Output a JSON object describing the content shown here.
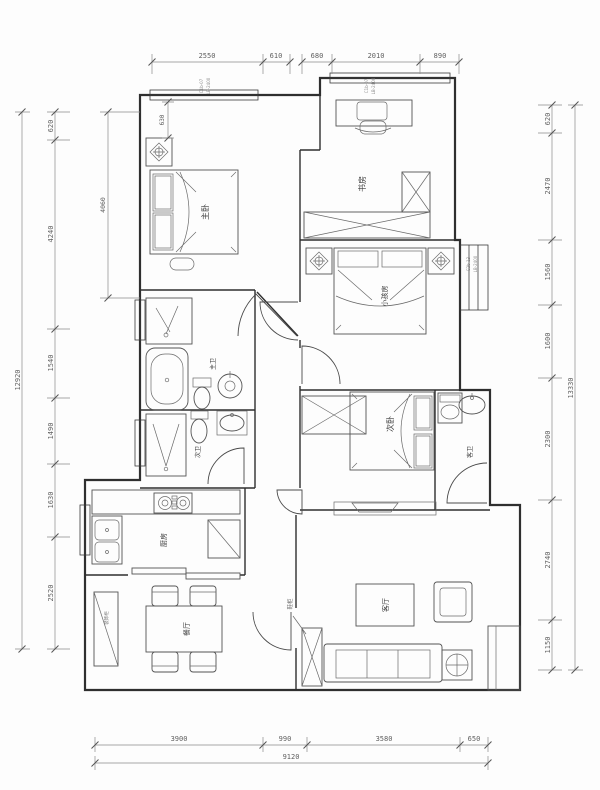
{
  "drawing": {
    "kind": "apartment-floor-plan",
    "line_color": "#2f2f2f",
    "background": "#fdfdfd",
    "rooms": {
      "master_bedroom": "主卧",
      "study": "书房",
      "kids_room": "小孩房",
      "second_bedroom": "次卧",
      "master_bath": "主卫",
      "second_bath": "次卫",
      "guest_bath": "客卫",
      "kitchen": "厨房",
      "dining": "餐厅",
      "living": "客厅"
    },
    "annotations": {
      "shoe_cabinet": "鞋柜",
      "hall_cabinet": "装饰柜"
    },
    "window_codes": {
      "top_left": [
        "C1b-07",
        "LB-2400"
      ],
      "top_right": [
        "C1b-07",
        "LB-2400"
      ],
      "right_side": [
        "C2b-13",
        "LB-2400"
      ]
    },
    "dims": {
      "top": [
        "2550",
        "610",
        "680",
        "2010",
        "890"
      ],
      "bottom": [
        "3900",
        "990",
        "3580",
        "650"
      ],
      "bottom_total": "9120",
      "left": [
        "620",
        "4240",
        "1540",
        "1490",
        "1630",
        "2520"
      ],
      "left_total": "12920",
      "right": [
        "620",
        "2470",
        "1560",
        "1600",
        "2300",
        "2740",
        "1150"
      ],
      "right_total": "13330",
      "internal": {
        "window_offset": "630",
        "bedroom_depth": "4060"
      }
    }
  }
}
